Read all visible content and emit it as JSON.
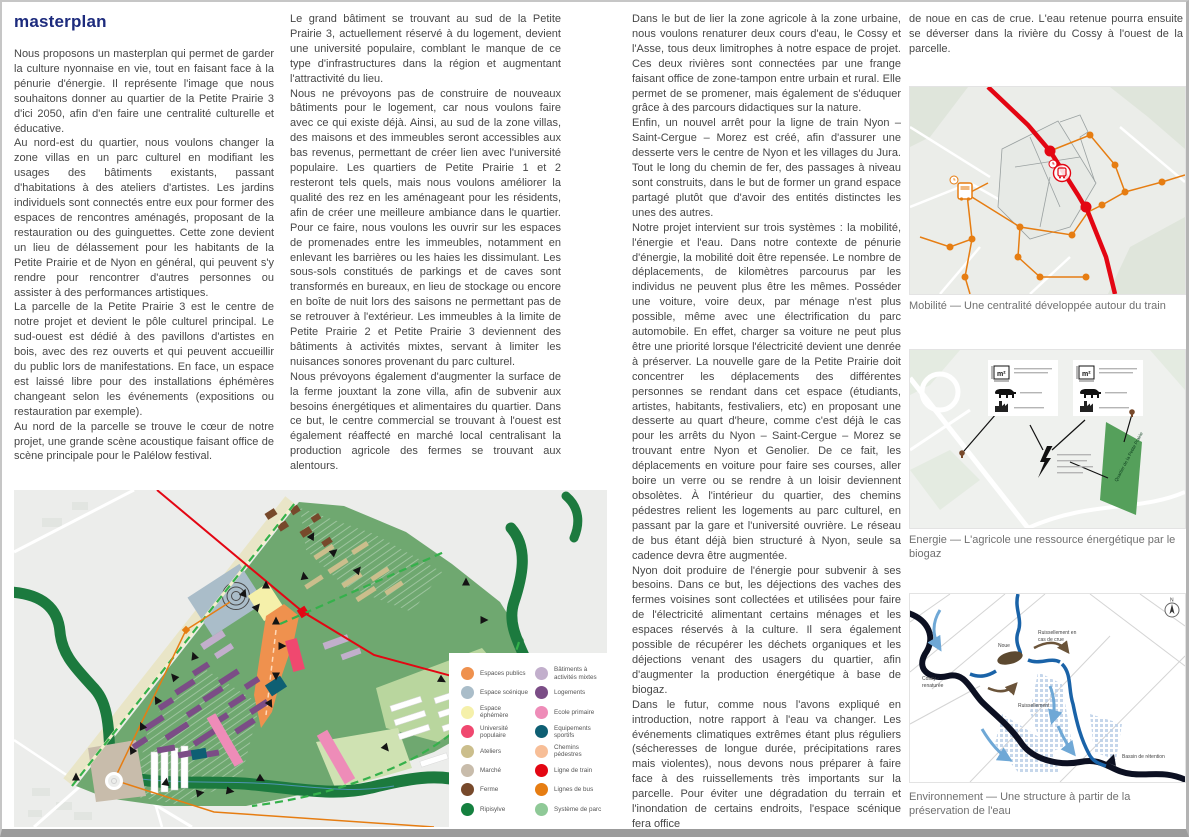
{
  "page": {
    "title": "masterplan"
  },
  "columns": {
    "col1": [
      "Nous proposons un masterplan qui permet de garder la culture nyonnaise en vie, tout en faisant face à la pénurie d'énergie. Il représente l'image que nous souhaitons donner au quartier de la Petite Prairie 3 d'ici 2050, afin d'en faire une centralité culturelle et éducative.",
      "Au nord-est du quartier, nous voulons changer la zone villas en un parc culturel en modifiant les usages des bâtiments existants, passant d'habitations à des ateliers d'artistes. Les jardins individuels sont connectés entre eux pour former des espaces de rencontres aménagés, proposant de la restauration ou des guinguettes. Cette zone devient un lieu de délassement pour les habitants de la Petite Prairie et de Nyon en général, qui peuvent s'y rendre pour rencontrer d'autres personnes ou assister à des performances artistiques.",
      "La parcelle de la Petite Prairie 3 est le centre de notre projet et devient le pôle culturel principal. Le sud-ouest est dédié à des pavillons d'artistes en bois, avec des rez ouverts et qui peuvent accueillir du public lors de manifestations. En face, un espace est laissé libre pour des installations éphémères changeant selon les événements (expositions ou restauration par exemple).",
      "Au nord de la parcelle se trouve le cœur de notre projet, une grande scène acoustique faisant office de scène principale pour le Palélow festival."
    ],
    "col2": [
      "Le grand bâtiment se trouvant au sud de la Petite Prairie 3, actuellement réservé à du logement, devient une université populaire, comblant le manque de ce type d'infrastructures dans la région et augmentant l'attractivité du lieu.",
      "Nous ne prévoyons pas de construire de nouveaux bâtiments pour le logement, car nous voulons faire avec ce qui existe déjà. Ainsi, au sud de la zone villas, des maisons et des immeubles seront accessibles aux bas revenus, permettant de créer lien avec l'université populaire. Les quartiers de Petite Prairie 1 et 2 resteront tels quels, mais nous voulons améliorer la qualité des rez en les aménageant pour les résidents, afin de créer une meilleure ambiance dans le quartier. Pour ce faire, nous voulons les ouvrir sur les espaces de promenades entre les immeubles, notamment en enlevant les barrières ou les haies les dissimulant. Les sous-sols constitués de parkings et de caves sont transformés en bureaux, en lieu de stockage ou encore en boîte de nuit lors des saisons ne permettant pas de se retrouver à l'extérieur. Les immeubles à la limite de Petite Prairie 2 et Petite Prairie 3 deviennent des bâtiments à activités mixtes, servant à limiter les nuisances sonores provenant du parc culturel.",
      "Nous prévoyons également d'augmenter la surface de la ferme jouxtant la zone villa, afin de subvenir aux besoins énergétiques et alimentaires du quartier. Dans ce but, le centre commercial se trouvant à l'ouest est également réaffecté en marché local centralisant la production agricole des fermes se trouvant aux alentours."
    ],
    "col3": [
      "Dans le but de lier la zone agricole à la zone urbaine, nous voulons renaturer deux cours d'eau, le Cossy et l'Asse, tous deux limitrophes à notre espace de projet. Ces deux rivières sont connectées par une frange faisant office de zone-tampon entre urbain et rural. Elle permet de se promener, mais également de s'éduquer grâce à des parcours didactiques sur la nature.",
      "Enfin, un nouvel arrêt pour la ligne de train Nyon – Saint-Cergue – Morez est créé, afin d'assurer une desserte vers le centre de Nyon et les villages du Jura. Tout le long du chemin de fer, des passages à niveau sont construits, dans le but de former un grand espace partagé plutôt que d'avoir des entités distinctes les unes des autres.",
      "Notre projet intervient sur trois systèmes : la mobilité, l'énergie et l'eau. Dans notre contexte de pénurie d'énergie, la mobilité doit être repensée. Le nombre de déplacements, de kilomètres parcourus par les individus ne peuvent plus être les mêmes. Posséder une voiture, voire deux, par ménage n'est plus possible, même avec une électrification du parc automobile. En effet, charger sa voiture ne peut plus être une priorité lorsque l'électricité devient une denrée à préserver. La nouvelle gare de la Petite Prairie doit concentrer les déplacements des différentes personnes se rendant dans cet espace (étudiants, artistes, habitants, festivaliers, etc) en proposant une desserte au quart d'heure, comme c'est déjà le cas pour les arrêts du Nyon – Saint-Cergue – Morez se trouvant entre Nyon et Genolier. De ce fait, les déplacements en voiture pour faire ses courses, aller boire un verre ou se rendre à un loisir deviennent obsolètes. À l'intérieur du quartier, des chemins pédestres relient les logements au parc culturel, en passant par la gare et l'université ouvrière. Le réseau de bus étant déjà bien structuré à Nyon, seule sa cadence devra être augmentée.",
      "Nyon doit produire de l'énergie pour subvenir à ses besoins. Dans ce but, les déjections des vaches des fermes voisines sont collectées et utilisées pour faire de l'électricité alimentant certains ménages et les espaces réservés à la culture. Il sera également possible de récupérer les déchets organiques et les déjections venant des usagers du quartier, afin d'augmenter la production énergétique à base de biogaz.",
      "Dans le futur, comme nous l'avons expliqué en introduction, notre rapport à l'eau va changer. Les événements climatiques extrêmes étant plus réguliers (sécheresses de longue durée, précipitations rares mais violentes), nous devons nous préparer à faire face à des ruissellements très importants sur la parcelle. Pour éviter une dégradation du terrain et l'inondation de certains endroits, l'espace scénique fera office"
    ],
    "col4": [
      "de noue en cas de crue. L'eau retenue pourra ensuite se déverser dans la rivière du Cossy à l'ouest de la parcelle."
    ]
  },
  "legend": {
    "items": [
      {
        "label": "Espaces publics",
        "color": "#EF914E"
      },
      {
        "label": "Espace scénique",
        "color": "#AABDC9"
      },
      {
        "label": "Espace éphémère",
        "color": "#F5F0AA"
      },
      {
        "label": "Université populaire",
        "color": "#F0486F"
      },
      {
        "label": "Ateliers",
        "color": "#CBBE8C"
      },
      {
        "label": "Marché",
        "color": "#C8BCAB"
      },
      {
        "label": "Ferme",
        "color": "#77492B"
      },
      {
        "label": "Ripisylve",
        "color": "#15803F"
      },
      {
        "label": "Bâtiments à activités mixtes",
        "color": "#C2AFCC"
      },
      {
        "label": "Logements",
        "color": "#7B4D86"
      },
      {
        "label": "Ecole primaire",
        "color": "#EE8CB8"
      },
      {
        "label": "Equipements sportifs",
        "color": "#0E5F73"
      },
      {
        "label": "Chemins pédestres",
        "color": "#F7BE97"
      },
      {
        "label": "Ligne de train",
        "color": "#E30613"
      },
      {
        "label": "Lignes de bus",
        "color": "#E67D12"
      },
      {
        "label": "Système de parc",
        "color": "#8FC997"
      }
    ]
  },
  "maps": {
    "mobilite": {
      "caption": "Mobilité — Une centralité développée autour du train"
    },
    "energie": {
      "caption": "Energie — L'agricole une ressource énergétique par le biogaz",
      "labels": {
        "m2_left": "m²",
        "m2_right": "m²",
        "quartier": "Quartier de la Petite Prairie"
      }
    },
    "environnement": {
      "caption": "Environnement — Une structure à partir de la préservation de l'eau",
      "labels": {
        "noue": "Noue",
        "ruissellement_crue_1": "Ruissellement en",
        "ruissellement_crue_2": "cas de crue",
        "cossy_1": "Cossy -",
        "cossy_2": "renaturée",
        "ruissellement": "Ruissellement",
        "bassin": "Bassin de rétention",
        "north": "N"
      }
    }
  }
}
